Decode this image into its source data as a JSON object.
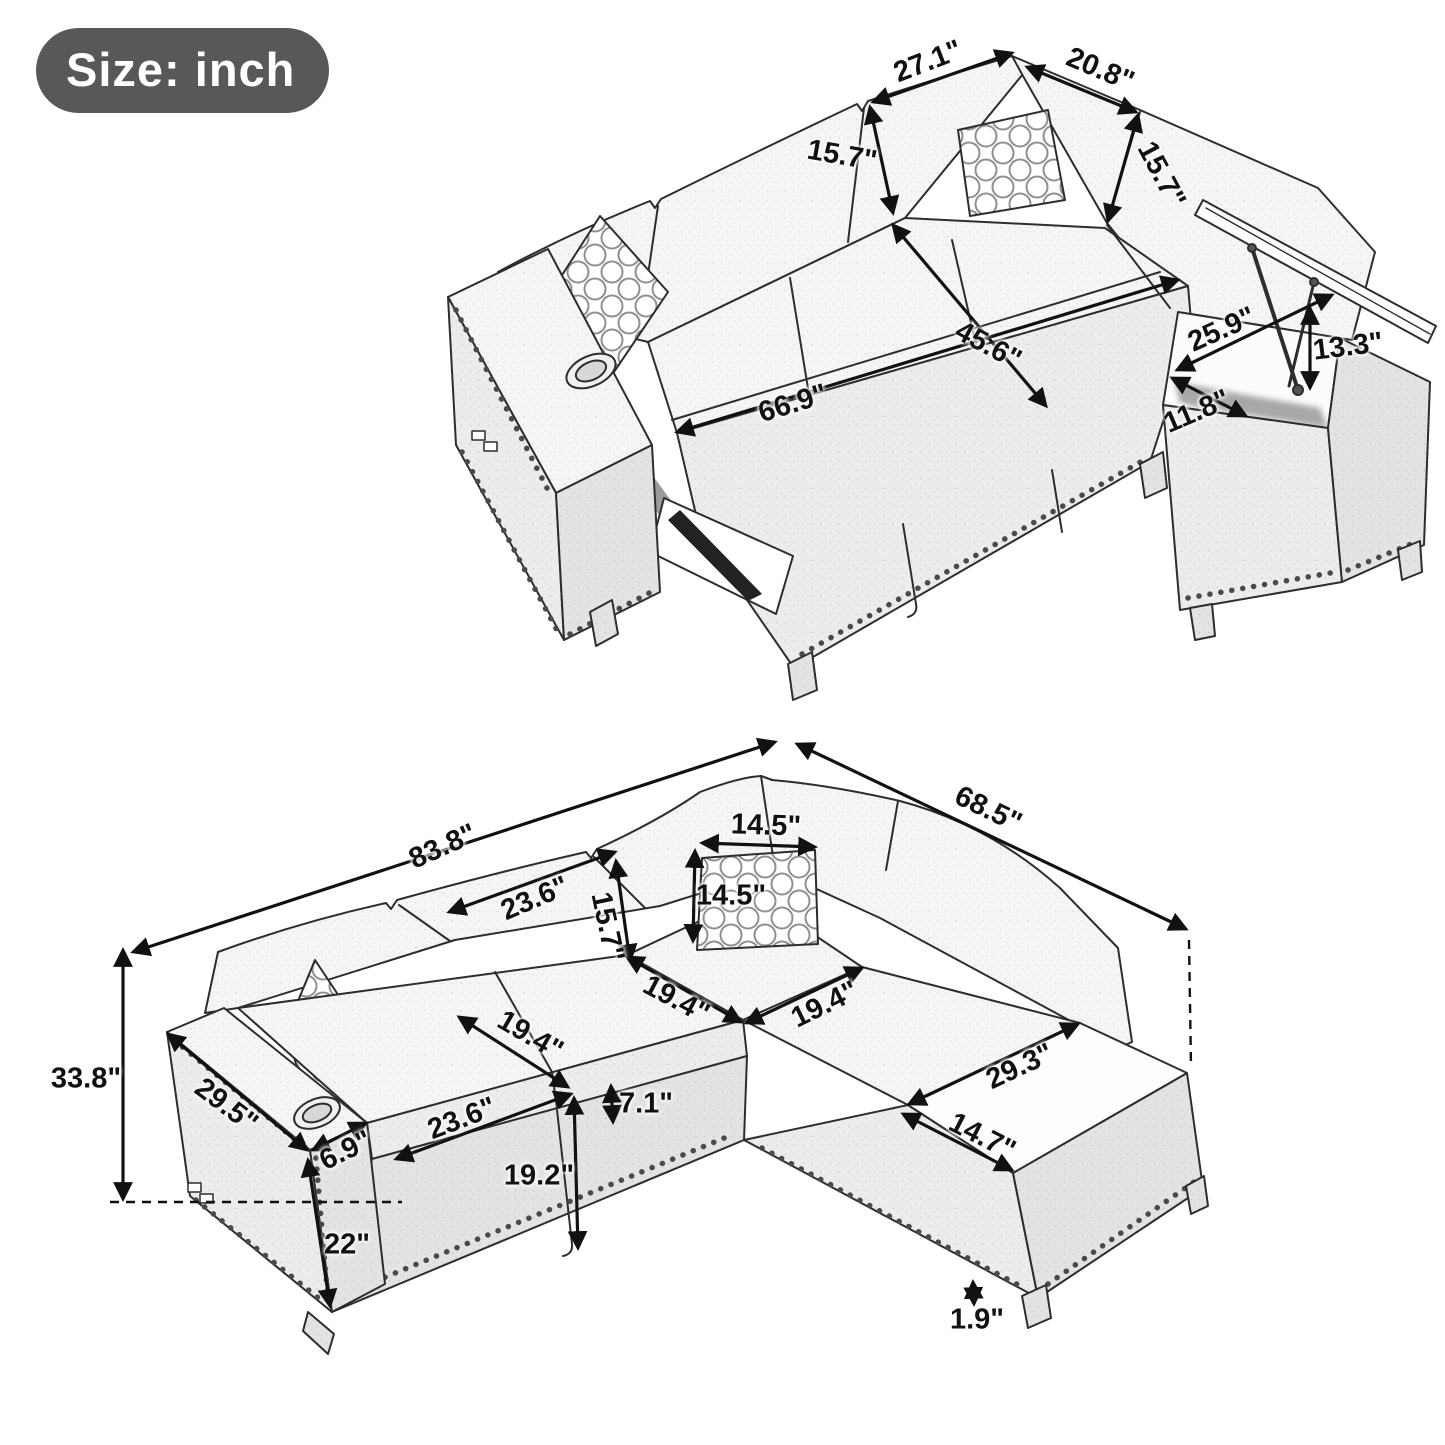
{
  "badge": {
    "label": "Size: inch"
  },
  "colors": {
    "badge_bg": "#58585a",
    "badge_text": "#ffffff",
    "ink": "#111111",
    "sketch_line": "#2d2d2d",
    "fabric_fill": "#f5f5f3"
  },
  "open_view": {
    "dims": {
      "back_left_width": "27.1\"",
      "back_right_width": "20.8\"",
      "back_height_left": "15.7\"",
      "back_height_right": "15.7\"",
      "bed_width": "45.6\"",
      "bed_length": "66.9\"",
      "storage_length": "25.9\"",
      "storage_width": "11.8\"",
      "storage_depth": "13.3\""
    }
  },
  "closed_view": {
    "dims": {
      "total_width": "83.8\"",
      "total_depth": "68.5\"",
      "back_cushion_width": "23.6\"",
      "back_cushion_height": "15.7\"",
      "pillow_width": "14.5\"",
      "pillow_height": "14.5\"",
      "corner_seat_left": "19.4\"",
      "corner_seat_right": "19.4\"",
      "seat_depth": "19.4\"",
      "seat_width": "23.6\"",
      "seat_front_height": "7.1\"",
      "seat_height_floor": "19.2\"",
      "overall_height": "33.8\"",
      "arm_length": "29.5\"",
      "arm_width": "6.9\"",
      "arm_front_height": "22\"",
      "chaise_top_length": "29.3\"",
      "chaise_top_width": "14.7\"",
      "leg_height": "1.9\""
    }
  }
}
